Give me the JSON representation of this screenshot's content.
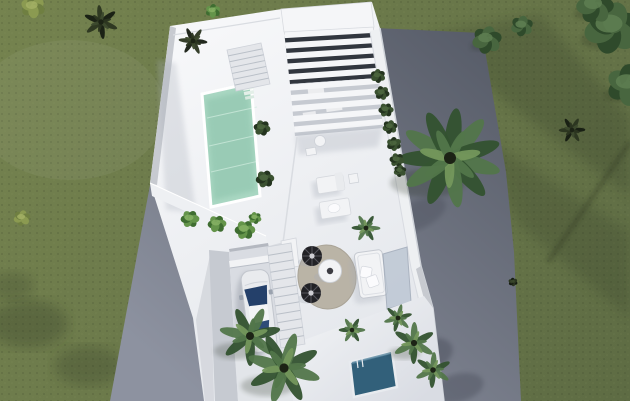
{
  "meta": {
    "width": 630,
    "height": 401,
    "kind": "3d-architectural-render"
  },
  "scene": {
    "description": "Aerial top-down 3D architectural render of a modern white villa with a rooftop mint-green swimming pool, louvered white pergola, sun loungers, round rug with black wire chairs and white sofa on the terrace, a driveway with a parked white car beside a staircase, a small lower plunge pool, palm trees and dark bushes on olive-green grass, and a gray paved road running diagonally behind the house."
  },
  "colors": {
    "grass-base": "#6e7c4f",
    "grass-dark": "#5e6c44",
    "grass-shadow": "#232b1a",
    "road-dark": "#575c68",
    "road-light": "#8d92a0",
    "platform": "#f3f4f6",
    "platform-edge": "#d9dce1",
    "wall-shade": "#c7cad0",
    "deck-shadow": "#a6acb7",
    "pool-water": "#a9d7c2",
    "pool-deep": "#8cc2ab",
    "pool-ripple": "#d2ecdf",
    "lower-pool": "#32607a",
    "lower-pool-edge": "#5e8ba4",
    "pergola-gap-dark": "#31363e",
    "pergola-gap-light": "#c6cad1",
    "slat": "#f5f6f8",
    "stair-base": "#e4e6ea",
    "stair-line": "#bac0c8",
    "drive-floor": "#d9dce2",
    "drive-wall": "#c6cad1",
    "garage-shadow": "#b4b8c0",
    "car-body": "#e9ebee",
    "car-glass": "#24406a",
    "car-glass2": "#2e4c78",
    "car-line": "#c2c6cd",
    "rug": "#b5ae9f",
    "rug-edge": "#a39c8d",
    "chair-black": "#222226",
    "chair-spoke": "#55555c",
    "furniture-white": "#f2f3f5",
    "furniture-line": "#cdd1d7",
    "glass-wall": "#b7c2d0",
    "glass-frame": "#97a2b2"
  },
  "palettes": {
    "green": [
      "#33522f",
      "#52764a",
      "#74975c"
    ],
    "dark": [
      "#161c12",
      "#2b3520",
      "#3d4a2e"
    ],
    "bright": [
      "#3f6d31",
      "#64944a",
      "#86b264"
    ],
    "hedge": [
      "#24341f",
      "#3a5130",
      "#4d6740"
    ],
    "olive": [
      "#6f7f41",
      "#8b9a51",
      "#a3b065"
    ],
    "tree": [
      "#2f4a2b",
      "#48663f",
      "#5f7f52"
    ]
  },
  "pergola": {
    "slats": 10,
    "top": [
      [
        284,
        31
      ],
      [
        373,
        26
      ]
    ],
    "bottom": [
      [
        295,
        136
      ],
      [
        383,
        128
      ]
    ]
  },
  "stairs": [
    {
      "name": "pool-stairs",
      "quad": [
        [
          227,
          50
        ],
        [
          261,
          43
        ],
        [
          270,
          84
        ],
        [
          236,
          91
        ]
      ],
      "steps": 7
    },
    {
      "name": "driveway-stairs",
      "quad": [
        [
          267,
          247
        ],
        [
          291,
          243
        ],
        [
          305,
          344
        ],
        [
          281,
          348
        ]
      ],
      "steps": 12
    }
  ],
  "vegetation": [
    {
      "t": "palm",
      "x": 450,
      "y": 158,
      "r": 50,
      "p": "green"
    },
    {
      "t": "palm",
      "x": 250,
      "y": 336,
      "r": 30,
      "p": "green"
    },
    {
      "t": "palm",
      "x": 284,
      "y": 368,
      "r": 36,
      "p": "green"
    },
    {
      "t": "palm",
      "x": 414,
      "y": 343,
      "r": 21,
      "p": "green"
    },
    {
      "t": "palm",
      "x": 433,
      "y": 370,
      "r": 18,
      "p": "green"
    },
    {
      "t": "palm",
      "x": 398,
      "y": 318,
      "r": 14,
      "p": "green"
    },
    {
      "t": "palm",
      "x": 352,
      "y": 330,
      "r": 13,
      "p": "green"
    },
    {
      "t": "palm",
      "x": 366,
      "y": 228,
      "r": 14,
      "p": "green"
    },
    {
      "t": "palm",
      "x": 101,
      "y": 22,
      "r": 17,
      "p": "dark"
    },
    {
      "t": "palm",
      "x": 193,
      "y": 41,
      "r": 14,
      "p": "dark"
    },
    {
      "t": "palm",
      "x": 572,
      "y": 130,
      "r": 13,
      "p": "dark"
    },
    {
      "t": "bush",
      "x": 33,
      "y": 7,
      "r": 13,
      "p": "olive"
    },
    {
      "t": "bush",
      "x": 213,
      "y": 11,
      "r": 8,
      "p": "bright"
    },
    {
      "t": "bush",
      "x": 22,
      "y": 218,
      "r": 9,
      "p": "olive"
    },
    {
      "t": "bush",
      "x": 513,
      "y": 282,
      "r": 5,
      "p": "dark"
    },
    {
      "t": "bush",
      "x": 612,
      "y": 28,
      "r": 30,
      "p": "tree"
    },
    {
      "t": "bush",
      "x": 629,
      "y": 85,
      "r": 24,
      "p": "tree"
    },
    {
      "t": "bush",
      "x": 595,
      "y": 6,
      "r": 20,
      "p": "tree"
    },
    {
      "t": "bush",
      "x": 487,
      "y": 40,
      "r": 16,
      "p": "tree"
    },
    {
      "t": "bush",
      "x": 522,
      "y": 26,
      "r": 12,
      "p": "tree"
    },
    {
      "t": "bush",
      "x": 190,
      "y": 219,
      "r": 10,
      "p": "bright"
    },
    {
      "t": "bush",
      "x": 217,
      "y": 224,
      "r": 10,
      "p": "bright"
    },
    {
      "t": "bush",
      "x": 245,
      "y": 230,
      "r": 11,
      "p": "bright"
    },
    {
      "t": "bush",
      "x": 262,
      "y": 128,
      "r": 9,
      "p": "hedge"
    },
    {
      "t": "bush",
      "x": 265,
      "y": 179,
      "r": 10,
      "p": "hedge"
    },
    {
      "t": "bush",
      "x": 255,
      "y": 218,
      "r": 7,
      "p": "bright"
    },
    {
      "t": "bush",
      "x": 378,
      "y": 76,
      "r": 8,
      "p": "hedge"
    },
    {
      "t": "bush",
      "x": 382,
      "y": 93,
      "r": 8,
      "p": "hedge"
    },
    {
      "t": "bush",
      "x": 386,
      "y": 110,
      "r": 8,
      "p": "hedge"
    },
    {
      "t": "bush",
      "x": 390,
      "y": 127,
      "r": 8,
      "p": "hedge"
    },
    {
      "t": "bush",
      "x": 394,
      "y": 144,
      "r": 8,
      "p": "hedge"
    },
    {
      "t": "bush",
      "x": 397,
      "y": 160,
      "r": 8,
      "p": "hedge"
    },
    {
      "t": "bush",
      "x": 400,
      "y": 171,
      "r": 7,
      "p": "hedge"
    }
  ]
}
